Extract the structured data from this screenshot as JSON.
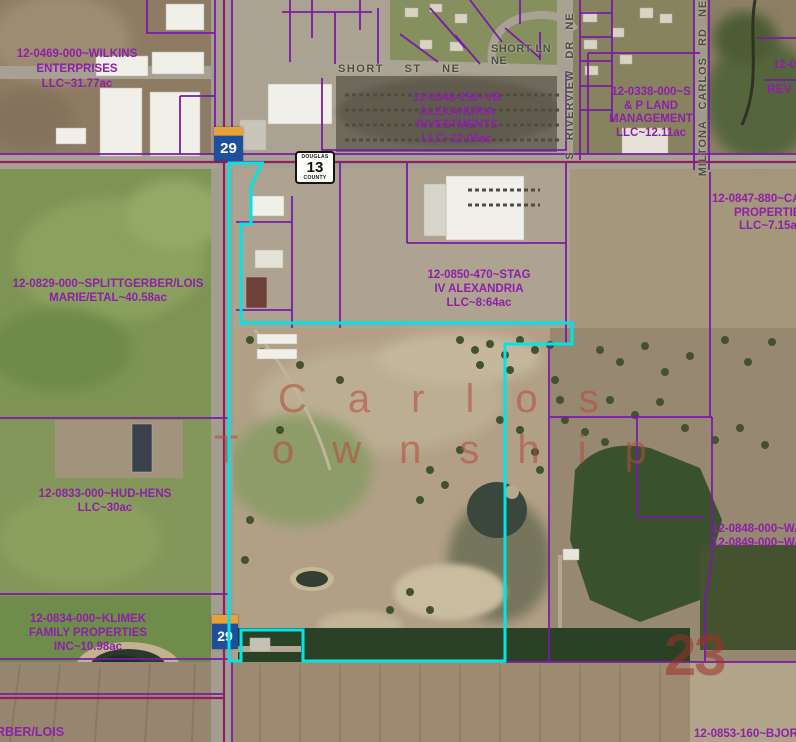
{
  "map": {
    "township": {
      "line1": "Carlos",
      "line2": "Township"
    },
    "section_number": "23",
    "highway_shield": {
      "route": "29"
    },
    "county_marker": {
      "line1": "DOUGLAS",
      "line2": "13",
      "line3": "COUNTY"
    },
    "parcels": [
      {
        "name": "wilkins",
        "lines": [
          "12-0469-000~WILKINS",
          "ENTERPRISES",
          "LLC~31.77ac"
        ]
      },
      {
        "name": "vb-alexandria",
        "lines": [
          "12-0348-250~VB",
          "ALEXANDRIA",
          "INVESTMENTS",
          "LLC~12.05ac"
        ]
      },
      {
        "name": "s-p-land",
        "lines": [
          "12-0338-000~S",
          "& P LAND",
          "MANAGEMENT",
          "LLC~12.11ac"
        ]
      },
      {
        "name": "car-properties",
        "lines": [
          "12-0847-880~CA",
          "PROPERTIES",
          "LLC~7.15ac"
        ]
      },
      {
        "name": "splittgerber",
        "lines": [
          "12-0829-000~SPLITTGERBER/LOIS",
          "MARIE/ETAL~40.58ac"
        ]
      },
      {
        "name": "stag",
        "lines": [
          "12-0850-470~STAG",
          "IV ALEXANDRIA",
          "LLC~8:64ac"
        ]
      },
      {
        "name": "hud-hens",
        "lines": [
          "12-0833-000~HUD-HENS",
          "LLC~30ac"
        ]
      },
      {
        "name": "klimek",
        "lines": [
          "12-0834-000~KLIMEK",
          "FAMILY PROPERTIES",
          "INC~10.98ac"
        ]
      },
      {
        "name": "wa-north",
        "lines": [
          "12-0848-000~WA",
          "12-0849-000~WA"
        ]
      },
      {
        "name": "bjorg",
        "lines": [
          "12-0853-160~BJORG"
        ]
      },
      {
        "name": "edge-sw",
        "lines": [
          "RBER/LOIS"
        ]
      },
      {
        "name": "edge-ne-1",
        "lines": [
          "12-0"
        ]
      },
      {
        "name": "edge-ne-2",
        "lines": [
          "REV"
        ]
      }
    ],
    "streets": {
      "short_st": "SHORT ST NE",
      "short_ln_line1": "SHORT LN",
      "short_ln_line2": "NE",
      "riverview": "S RIVERVIEW DR NE",
      "miltona": "MILTONA CARLOS RD NE"
    },
    "colors": {
      "parcel_label_text": "#8e1fa8",
      "parcel_boundary": "#7a1ba6",
      "road_boundary": "#8e2060",
      "selection_highlight": "#00e6e6",
      "township_text": "#b54b3c",
      "street_text": "#4c4c44",
      "shield_blue": "#1e4f9c",
      "shield_gold": "#e5a23a"
    }
  }
}
